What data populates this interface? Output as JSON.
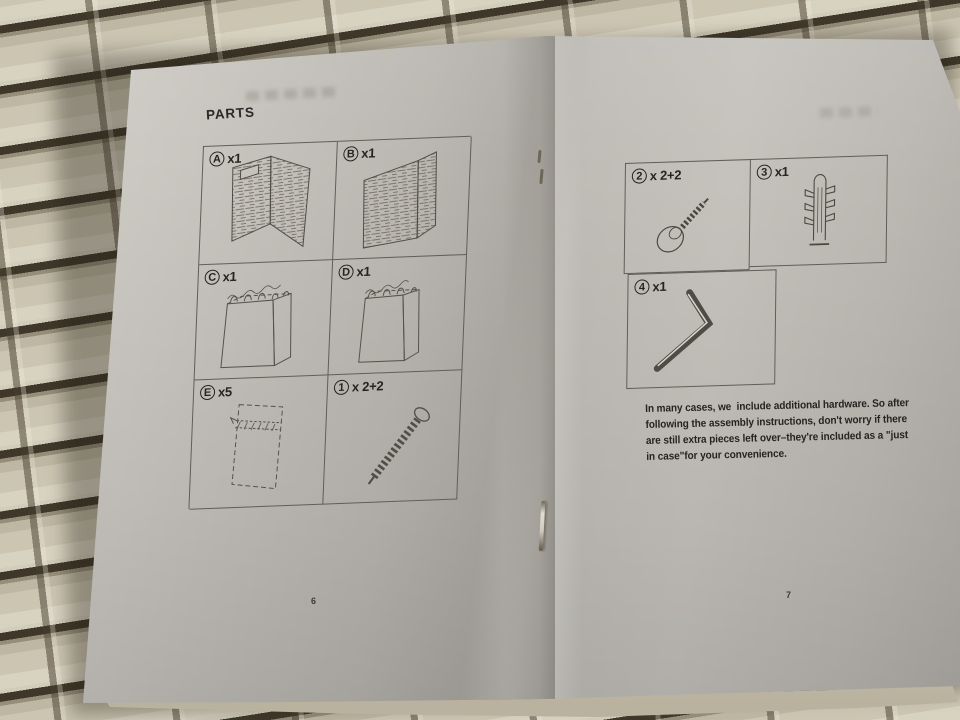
{
  "booklet": {
    "left_page": {
      "heading": "PARTS",
      "page_number": "6",
      "parts": [
        {
          "id": "A",
          "qty": "x1",
          "icon": "woven-corner-panel-with-handle"
        },
        {
          "id": "B",
          "qty": "x1",
          "icon": "woven-corner-panel"
        },
        {
          "id": "C",
          "qty": "x1",
          "icon": "fabric-liner-with-hooks"
        },
        {
          "id": "D",
          "qty": "x1",
          "icon": "fabric-liner-with-hooks"
        },
        {
          "id": "E",
          "qty": "x5",
          "icon": "flat-panel-with-strip"
        },
        {
          "id": "1",
          "qty": "x 2+2",
          "icon": "screw"
        }
      ]
    },
    "right_page": {
      "page_number": "7",
      "parts": [
        {
          "id": "2",
          "qty": "x 2+2",
          "icon": "cap-head-bolt"
        },
        {
          "id": "3",
          "qty": "x1",
          "icon": "wall-anchor"
        },
        {
          "id": "4",
          "qty": "x1",
          "icon": "hex-key"
        }
      ],
      "note_lines": [
        "In many cases, we  include additional hardware. So after",
        "following the assembly instructions, don't worry if there",
        "are still extra pieces left over–they're included as a \"just",
        "in case\"for your convenience."
      ]
    }
  },
  "colors": {
    "paper": "#c4c1bb",
    "weave_strip": "#d4cebd",
    "weave_gap": "#3f382a",
    "ink": "#2b2926"
  }
}
